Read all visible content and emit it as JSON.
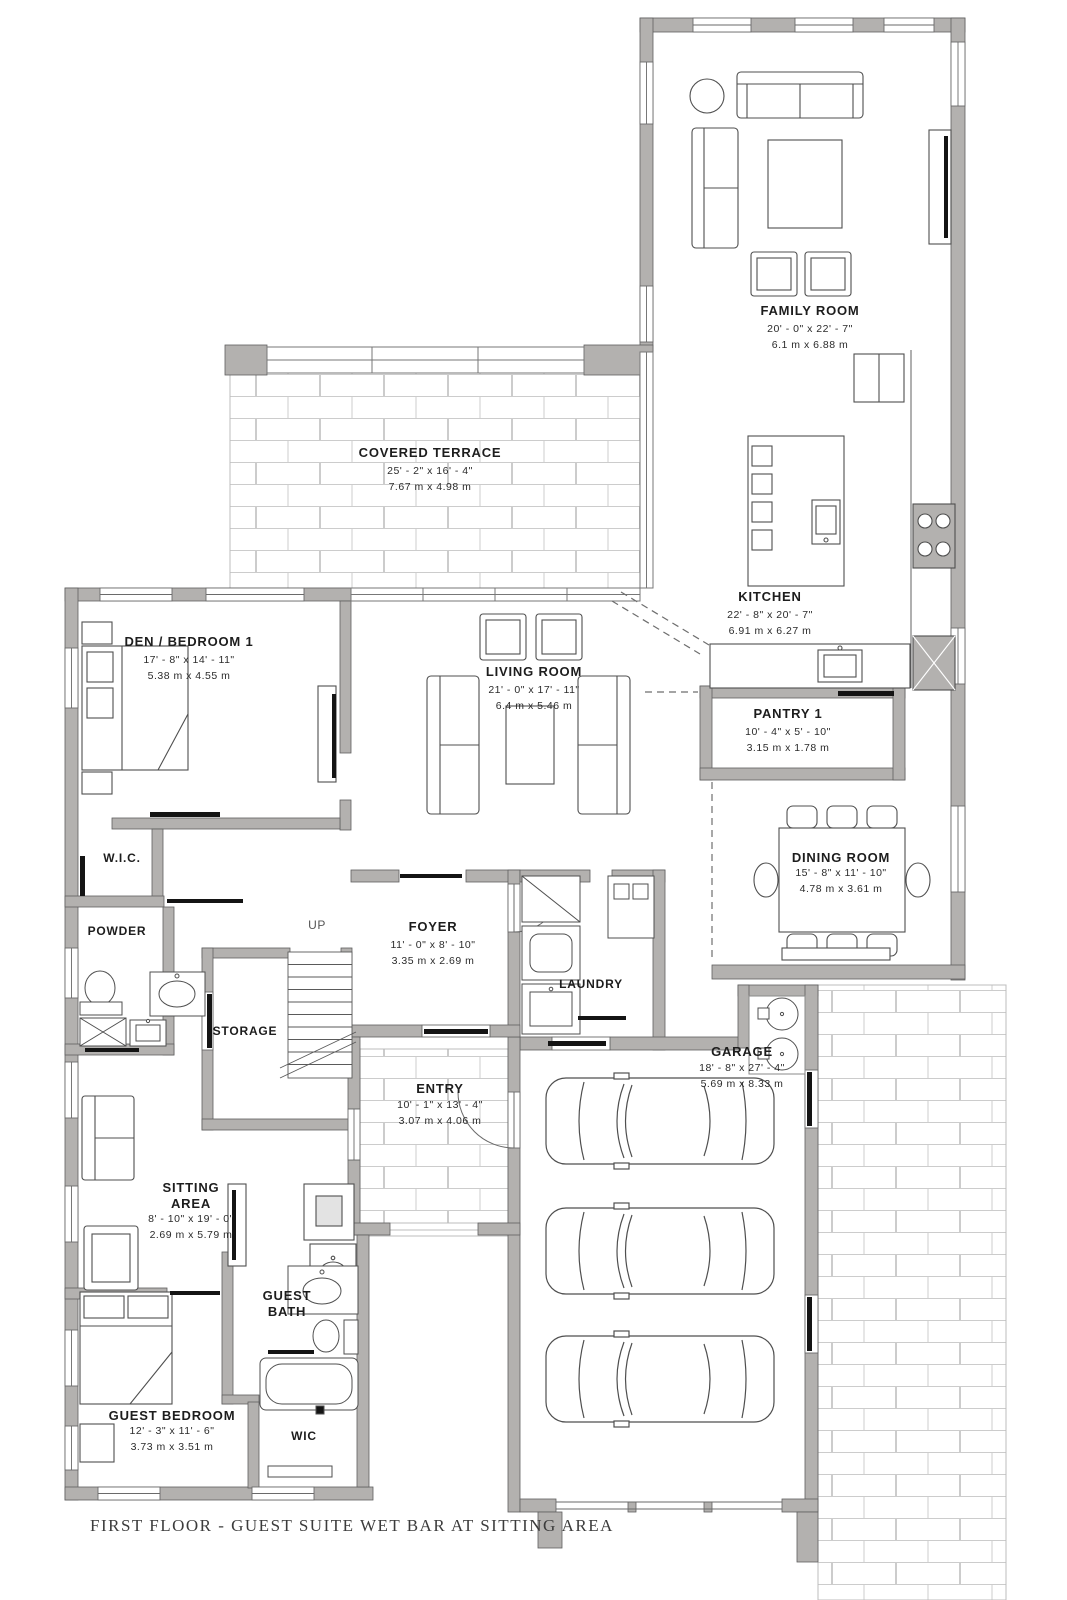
{
  "drawing_title": "FIRST FLOOR - GUEST SUITE WET BAR AT SITTING AREA",
  "stairs": {
    "up_label": "UP"
  },
  "colors": {
    "wall": "#b3b1af",
    "wall_edge": "#5f5f5f",
    "brick_joint": "#cccccc",
    "threshold": "#141414"
  },
  "rooms": {
    "family_room": {
      "name": "FAMILY ROOM",
      "dim_ft": "20' - 0\" x 22' - 7\"",
      "dim_m": "6.1 m x 6.88 m"
    },
    "covered_terrace": {
      "name": "COVERED TERRACE",
      "dim_ft": "25' - 2\" x 16' - 4\"",
      "dim_m": "7.67 m x 4.98 m"
    },
    "kitchen": {
      "name": "KITCHEN",
      "dim_ft": "22' - 8\" x 20' - 7\"",
      "dim_m": "6.91 m x 6.27 m"
    },
    "den_bedroom1": {
      "name": "DEN / BEDROOM 1",
      "dim_ft": "17' - 8\" x 14' - 11\"",
      "dim_m": "5.38 m x 4.55 m"
    },
    "living_room": {
      "name": "LIVING ROOM",
      "dim_ft": "21' - 0\" x 17' - 11\"",
      "dim_m": "6.4 m x 5.46 m"
    },
    "pantry1": {
      "name": "PANTRY 1",
      "dim_ft": "10' - 4\" x 5' - 10\"",
      "dim_m": "3.15 m x 1.78 m"
    },
    "dining_room": {
      "name": "DINING ROOM",
      "dim_ft": "15' - 8\" x 11' - 10\"",
      "dim_m": "4.78 m x 3.61 m"
    },
    "wic": {
      "name": "W.I.C."
    },
    "powder": {
      "name": "POWDER"
    },
    "foyer": {
      "name": "FOYER",
      "dim_ft": "11' - 0\" x 8' - 10\"",
      "dim_m": "3.35 m x 2.69 m"
    },
    "laundry": {
      "name": "LAUNDRY"
    },
    "storage": {
      "name": "STORAGE"
    },
    "entry": {
      "name": "ENTRY",
      "dim_ft": "10' - 1\" x 13' - 4\"",
      "dim_m": "3.07 m x 4.06 m"
    },
    "garage": {
      "name": "GARAGE",
      "dim_ft": "18' - 8\" x 27' - 4\"",
      "dim_m": "5.69 m x 8.33 m"
    },
    "sitting_area": {
      "name": "SITTING AREA",
      "dim_ft": "8' - 10\" x 19' - 0\"",
      "dim_m": "2.69 m x 5.79 m"
    },
    "guest_bath": {
      "name": "GUEST BATH"
    },
    "guest_bedroom": {
      "name": "GUEST BEDROOM",
      "dim_ft": "12' - 3\" x 11' - 6\"",
      "dim_m": "3.73 m x 3.51 m"
    },
    "guest_wic": {
      "name": "WIC"
    }
  }
}
